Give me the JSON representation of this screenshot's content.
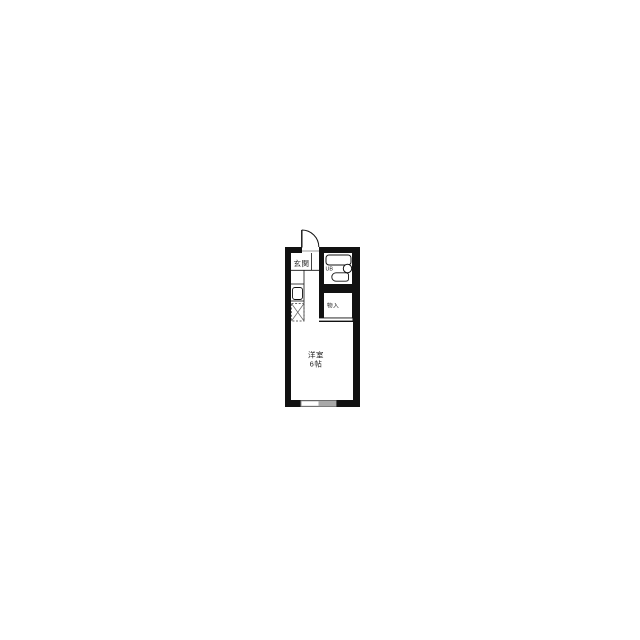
{
  "floor_plan": {
    "entrance_label": "玄関",
    "unit_bath_label": "UB",
    "storage_label": "物入",
    "main_room_label": "洋室",
    "main_room_size": "6帖",
    "colors": {
      "wall": "#111111",
      "background": "#ffffff",
      "interior": "#ffffff",
      "window_frame": "#8a8a8a",
      "window_pane": "#a8a8a8"
    }
  }
}
